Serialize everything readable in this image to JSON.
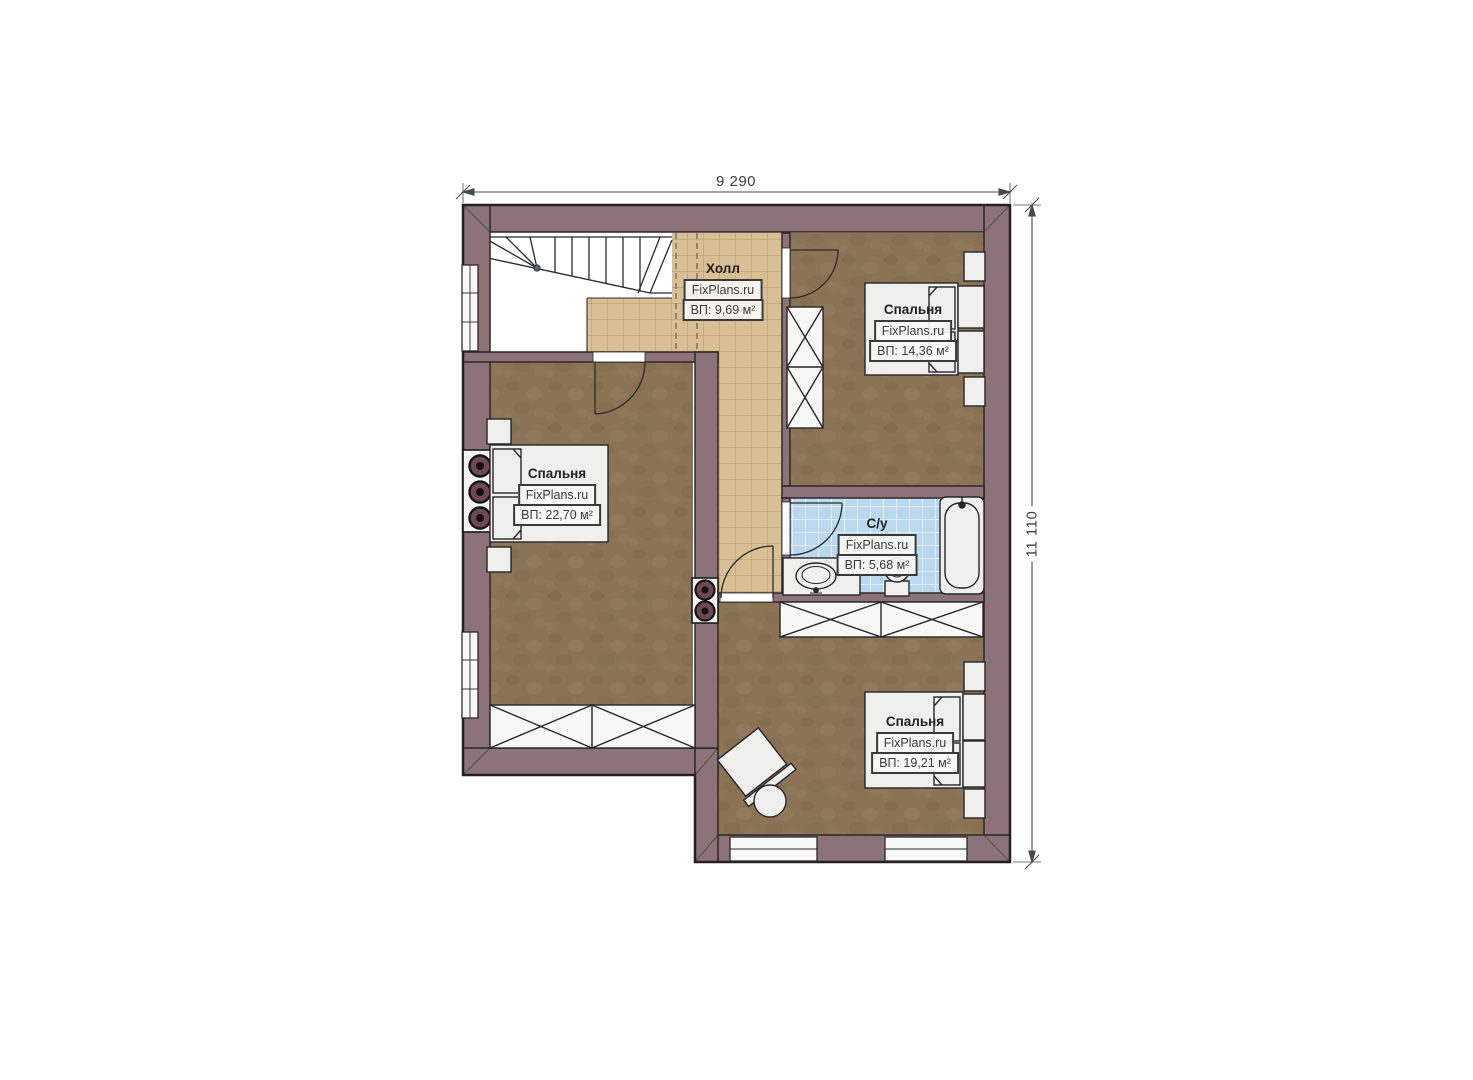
{
  "plan": {
    "dimensions": {
      "width": "9 290",
      "height": "11 110"
    },
    "rooms": [
      {
        "id": "hall",
        "name": "Холл",
        "brand": "FixPlans.ru",
        "area": "ВП: 9,69 м²"
      },
      {
        "id": "bedroom-top-right",
        "name": "Спальня",
        "brand": "FixPlans.ru",
        "area": "ВП: 14,36 м²"
      },
      {
        "id": "bedroom-left",
        "name": "Спальня",
        "brand": "FixPlans.ru",
        "area": "ВП: 22,70 м²"
      },
      {
        "id": "bathroom",
        "name": "С/у",
        "brand": "FixPlans.ru",
        "area": "ВП: 5,68 м²"
      },
      {
        "id": "bedroom-bottom",
        "name": "Спальня",
        "brand": "FixPlans.ru",
        "area": "ВП: 19,21 м²"
      }
    ],
    "colors": {
      "background": "#ffffff",
      "wall": "#8c737a",
      "wall_outline": "#2c2829",
      "carpet": "#8b7456",
      "hall_tile": "#d9c094",
      "hall_tile_line": "#a8906a",
      "bath_tile": "#bad9ef",
      "bath_tile_line": "#ffffff",
      "furniture": "#efefed",
      "dimension_line": "#4a4a4a"
    }
  }
}
